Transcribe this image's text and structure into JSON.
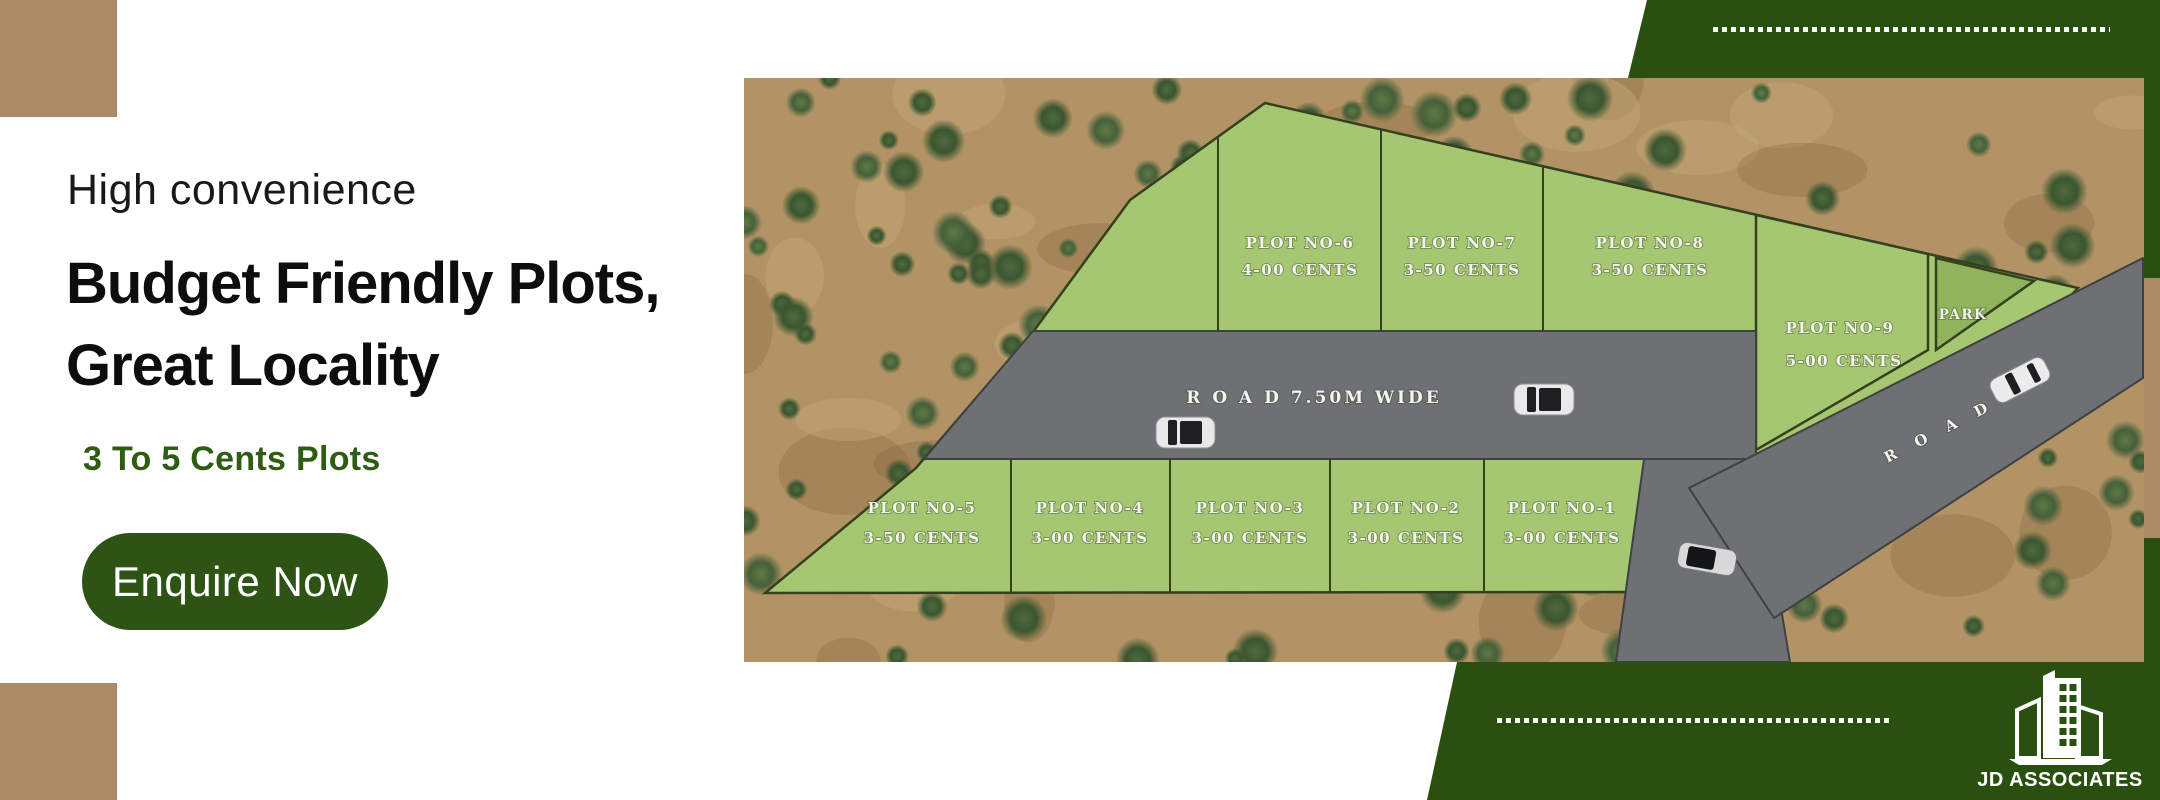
{
  "palette": {
    "band_green": "#2a500f",
    "button_green": "#2d5414",
    "accent_brown": "#ad8a66",
    "plot_green": "#a5c772",
    "park_green": "#8fb45c",
    "road_gray": "#6e7173",
    "terrain_tan": "#b29365",
    "subheadline_green": "#2d5c12"
  },
  "left_panel": {
    "kicker": "High convenience",
    "headline_line1": "Budget Friendly Plots,",
    "headline_line2": "Great Locality",
    "subheadline": "3 To 5 Cents Plots",
    "cta_label": "Enquire Now"
  },
  "brand": {
    "logo_text": "JD ASSOCIATES"
  },
  "site_plan": {
    "main_road_label": "R O A D 7.50M WIDE",
    "side_road_label": "R O A D",
    "park_label": "PARK",
    "plots": [
      {
        "name": "PLOT NO-6",
        "area": "4-00 CENTS"
      },
      {
        "name": "PLOT NO-7",
        "area": "3-50 CENTS"
      },
      {
        "name": "PLOT NO-8",
        "area": "3-50 CENTS"
      },
      {
        "name": "PLOT NO-9",
        "area": "5-00 CENTS"
      },
      {
        "name": "PLOT NO-5",
        "area": "3-50 CENTS"
      },
      {
        "name": "PLOT NO-4",
        "area": "3-00 CENTS"
      },
      {
        "name": "PLOT NO-3",
        "area": "3-00 CENTS"
      },
      {
        "name": "PLOT NO-2",
        "area": "3-00 CENTS"
      },
      {
        "name": "PLOT NO-1",
        "area": "3-00 CENTS"
      }
    ]
  }
}
